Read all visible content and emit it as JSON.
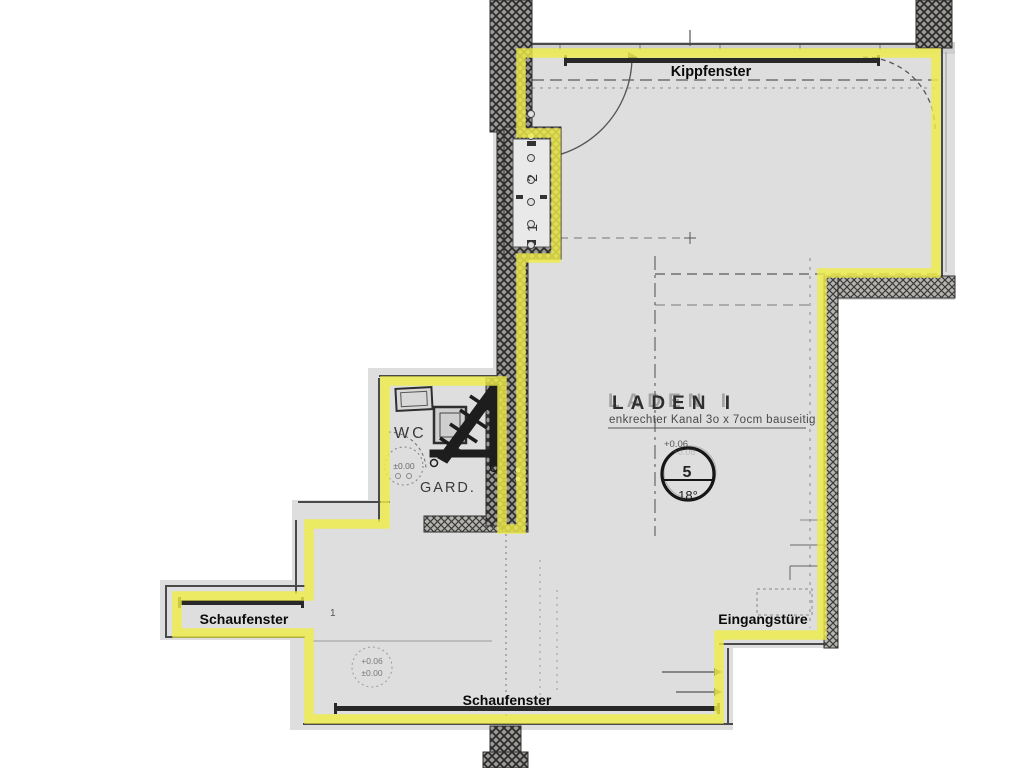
{
  "plan": {
    "window_labels": {
      "top": "Kippfenster",
      "left": "Schaufenster",
      "bottom": "Schaufenster"
    },
    "entrance_label": "Eingangstüre",
    "room": {
      "name": "LADEN I",
      "note": "enkrechter Kanal 3o x 7ocm bauseitig"
    },
    "wc_label": "WC",
    "garderobe_label": "GARD.",
    "shaft_numbers": {
      "top": "2",
      "bottom": "1"
    },
    "room_stamp": {
      "number": "5",
      "temperature": "18°",
      "elevation": "+0.06"
    },
    "elevation_stamps": {
      "wc": "±0.00",
      "floor_line1": "+0.06",
      "floor_line2": "±0.00",
      "bay_mark": "1"
    },
    "colors": {
      "highlight": "#efeb48",
      "floor": "#dedede",
      "wall_dark": "#2f2f2f"
    }
  }
}
